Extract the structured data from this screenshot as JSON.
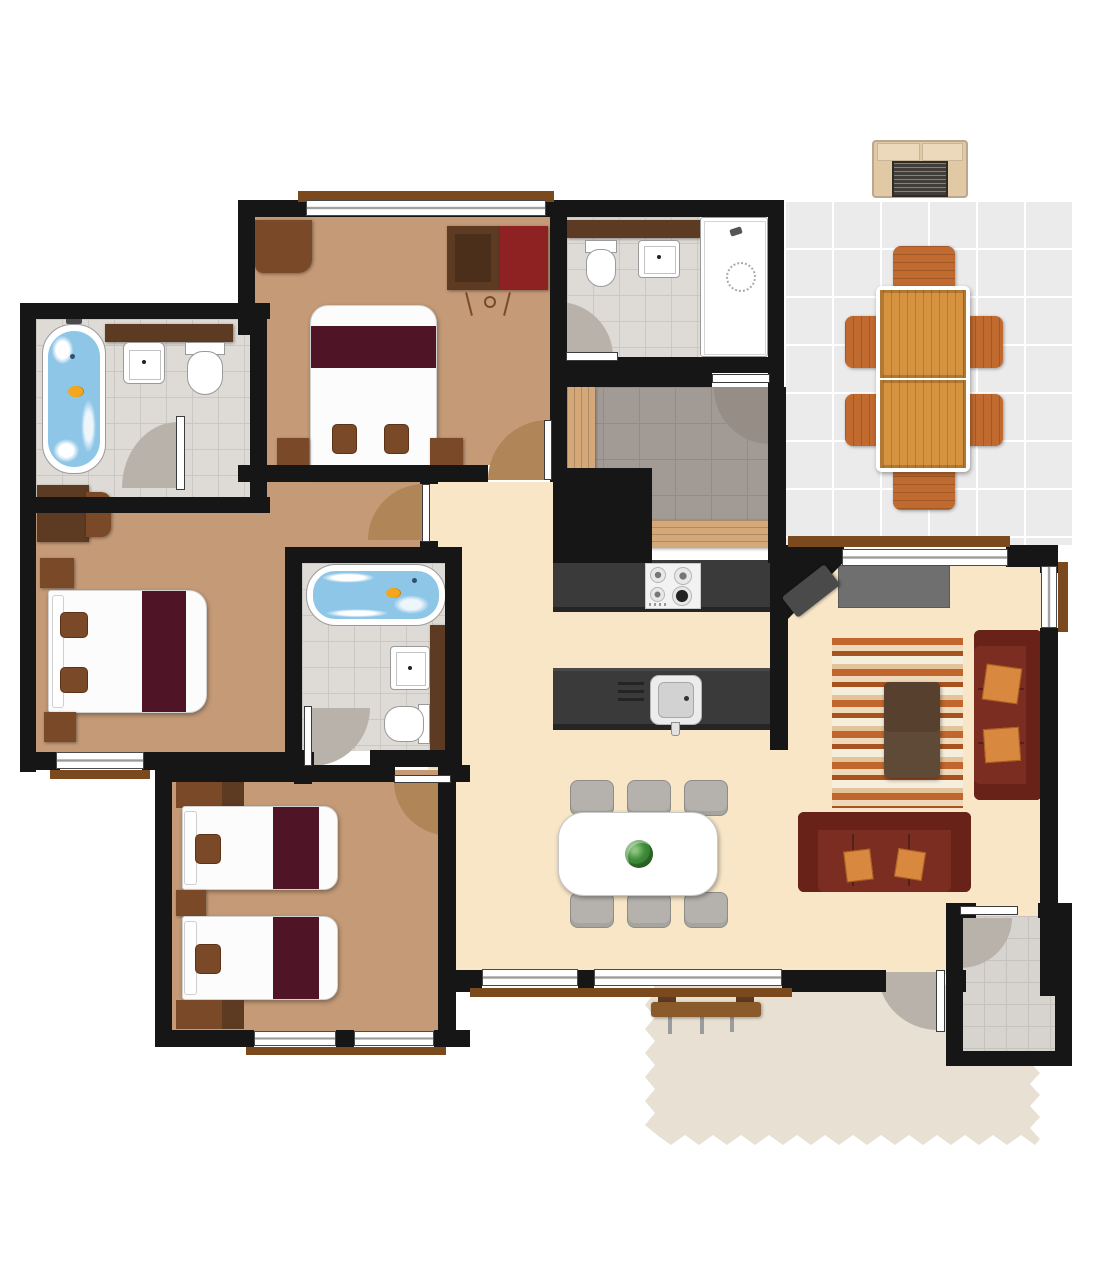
{
  "scene": {
    "type": "floor-plan",
    "description": "Top-down 2D rendered floor plan of a three-bedroom apartment with patio, deck and entry porch",
    "view": "top-down"
  },
  "colors": {
    "wall": "#161616",
    "floor_bedroom": "#c49a77",
    "floor_living": "#f8e6c7",
    "tile_bath": "#dedad5",
    "grout_bath": "#cbc7c2",
    "tile_storage": "#a29a94",
    "grout_storage": "#948d87",
    "tile_patio": "#ebebeb",
    "grout_patio": "#ffffff",
    "tile_porch": "#d7d4d0",
    "grout_porch": "#c6c3bf",
    "deck": "#e7e0d3",
    "arc_gray": "#b9b2ab",
    "arc_tan": "#b08557",
    "sill": "#7a4a1e",
    "duvet": "#fcfcfc",
    "blanket": "#4f1426",
    "pillow": "#7a4a28",
    "wood_dark": "#5d3a22",
    "wood_mid": "#7a4a28",
    "wardrobe_red": "#8e2121",
    "sofa": "#7b2d22",
    "sofa_dark": "#692218",
    "cushion": "#d8883f",
    "coffee_table": "#57412e",
    "counter": "#3a3a3a",
    "tv": "#6f6f6f",
    "speaker": "#4a4a4a",
    "wood_table": "#d6933f",
    "wood_chair": "#c06a30",
    "shelf_plank": "#d4a878",
    "water": "#8ec6e8",
    "duck": "#f2a71c",
    "plant": "#3e8d39",
    "chair_gray": "#b5b2ad",
    "bench": "#8a5a2a",
    "ac_body": "#e2c9a6",
    "ac_grille": "#413d39",
    "rug_a": "#c1662d",
    "rug_b": "#eed9ba",
    "rug_c": "#a8521f",
    "rug_d": "#f6eedd",
    "rug_e": "#e3c39a"
  },
  "rooms": [
    {
      "name": "bedroom-top-left",
      "floor": "tan",
      "furniture": [
        "double-bed",
        "nightstand-left",
        "nightstand-right",
        "armchair",
        "wardrobe-brown",
        "wardrobe-red",
        "hanger-rail"
      ]
    },
    {
      "name": "bathroom-top",
      "floor": "gray-tile",
      "furniture": [
        "toilet",
        "sink",
        "walk-in-shower",
        "shelf"
      ]
    },
    {
      "name": "bathroom-left",
      "floor": "gray-tile",
      "furniture": [
        "bathtub-with-water",
        "rubber-duck",
        "sink",
        "toilet",
        "shelf"
      ]
    },
    {
      "name": "master-bedroom",
      "floor": "tan",
      "furniture": [
        "double-bed",
        "nightstand-top",
        "nightstand-bottom",
        "desk",
        "desk-chair"
      ]
    },
    {
      "name": "ensuite-bathroom",
      "floor": "gray-tile",
      "furniture": [
        "bathtub-with-water",
        "rubber-duck",
        "sink",
        "toilet",
        "shelf"
      ]
    },
    {
      "name": "kids-bedroom",
      "floor": "tan",
      "furniture": [
        "single-bed-1",
        "single-bed-2",
        "nightstand-top",
        "nightstand-middle",
        "nightstand-bottom"
      ]
    },
    {
      "name": "storage-room",
      "floor": "dark-gray-tile",
      "furniture": [
        "plank-shelf-left",
        "plank-shelf-bottom"
      ]
    },
    {
      "name": "kitchen",
      "floor": "cream",
      "furniture": [
        "counter",
        "gas-hob-4-burner",
        "island-counter",
        "kitchen-sink",
        "drainboard"
      ]
    },
    {
      "name": "living-room",
      "floor": "cream",
      "furniture": [
        "tv-cabinet",
        "corner-speaker",
        "striped-rug",
        "coffee-table",
        "sofa-right",
        "sofa-bottom",
        "cushions-orange"
      ]
    },
    {
      "name": "dining-area",
      "floor": "cream",
      "furniture": [
        "dining-table",
        "plant-centerpiece",
        "chair-1",
        "chair-2",
        "chair-3",
        "chair-4",
        "chair-5",
        "chair-6"
      ]
    },
    {
      "name": "patio",
      "floor": "light-gray-tile",
      "furniture": [
        "outdoor-table",
        "outdoor-chair-top",
        "outdoor-chair-bottom",
        "outdoor-chair-left-1",
        "outdoor-chair-left-2",
        "outdoor-chair-right-1",
        "outdoor-chair-right-2",
        "ac-unit"
      ]
    },
    {
      "name": "entry-porch",
      "floor": "gray-tile",
      "furniture": [
        "front-door"
      ]
    },
    {
      "name": "deck",
      "floor": "decking",
      "furniture": [
        "bench"
      ]
    }
  ],
  "doors": [
    "bedroom-top-left-door",
    "master-bedroom-door",
    "bathroom-left-door",
    "bathroom-top-door",
    "storage-door",
    "ensuite-door",
    "kids-bedroom-door",
    "front-door",
    "deck-door"
  ],
  "windows": [
    "bedroom-top-left-window",
    "master-window",
    "kids-window-1",
    "kids-window-2",
    "living-bottom-window-1",
    "living-bottom-window-2",
    "living-top-window",
    "living-right-window"
  ]
}
